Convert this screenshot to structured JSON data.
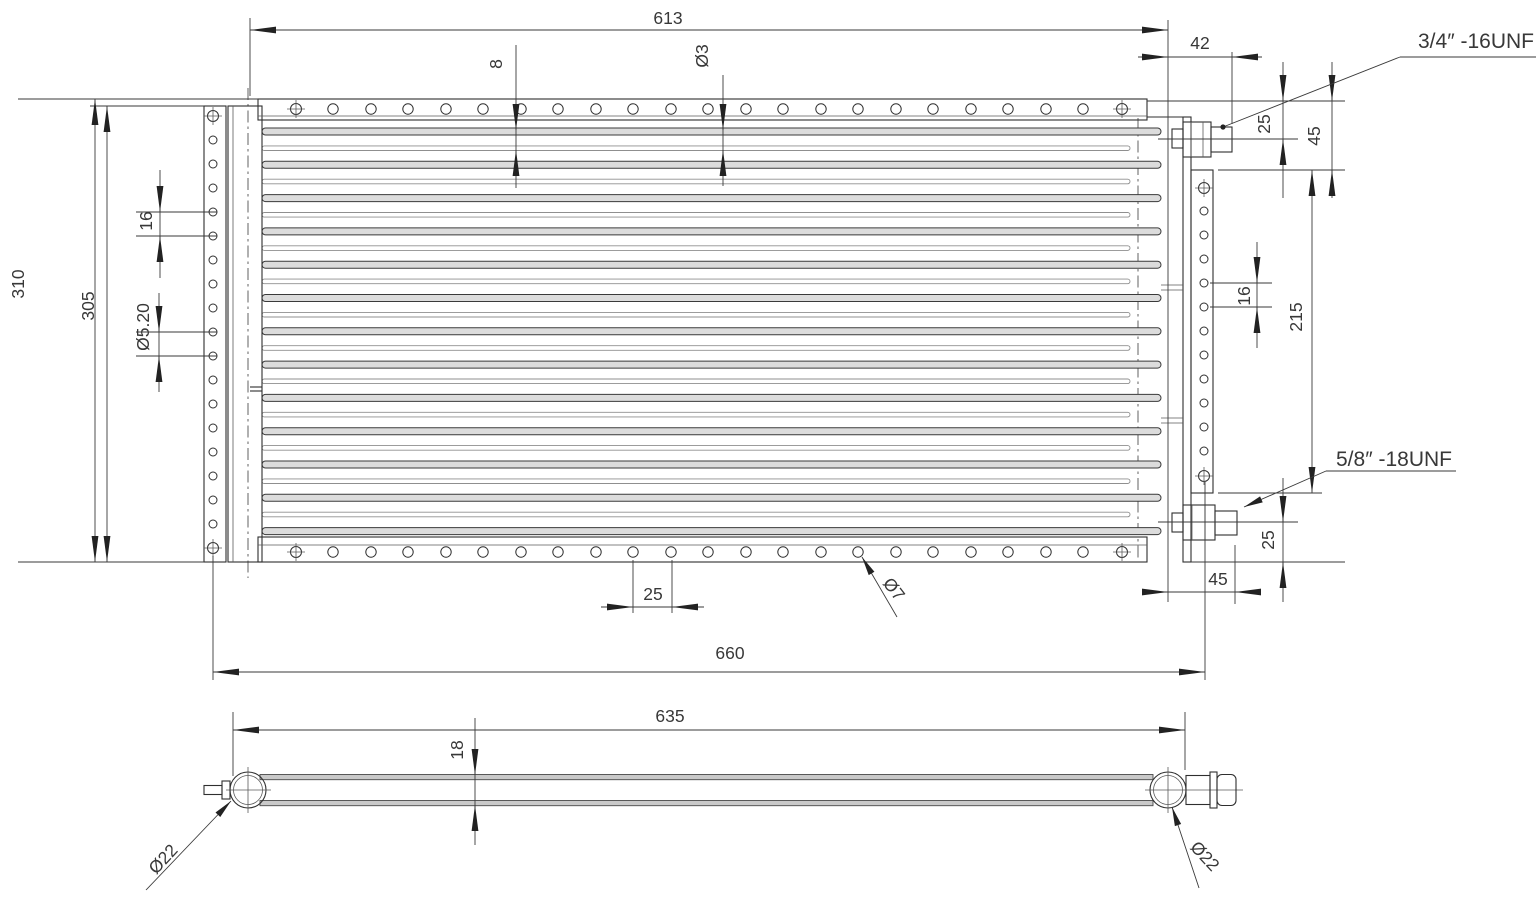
{
  "drawing": {
    "type": "technical-drawing",
    "subject": "condenser-coil-two-views",
    "colors": {
      "line": "#2f2f2f",
      "background": "#ffffff"
    },
    "labels": {
      "dim_613": "613",
      "dim_42": "42",
      "port_top": "3/4″ -16UNF",
      "dim_25_top": "25",
      "dim_45_top": "45",
      "dim_310": "310",
      "dim_305": "305",
      "dim_16_left": "16",
      "dim_hole_d520": "Ø5.20",
      "dim_8": "8",
      "dim_d3": "Ø3",
      "dim_16_right": "16",
      "dim_215": "215",
      "port_bottom": "5/8″ -18UNF",
      "dim_25_port_bottom": "25",
      "dim_45_bottom": "45",
      "dim_d7": "Ø7",
      "dim_25_holes": "25",
      "dim_660": "660",
      "dim_635": "635",
      "dim_18": "18",
      "dim_d22_left": "Ø22",
      "dim_d22_right": "Ø22"
    }
  }
}
